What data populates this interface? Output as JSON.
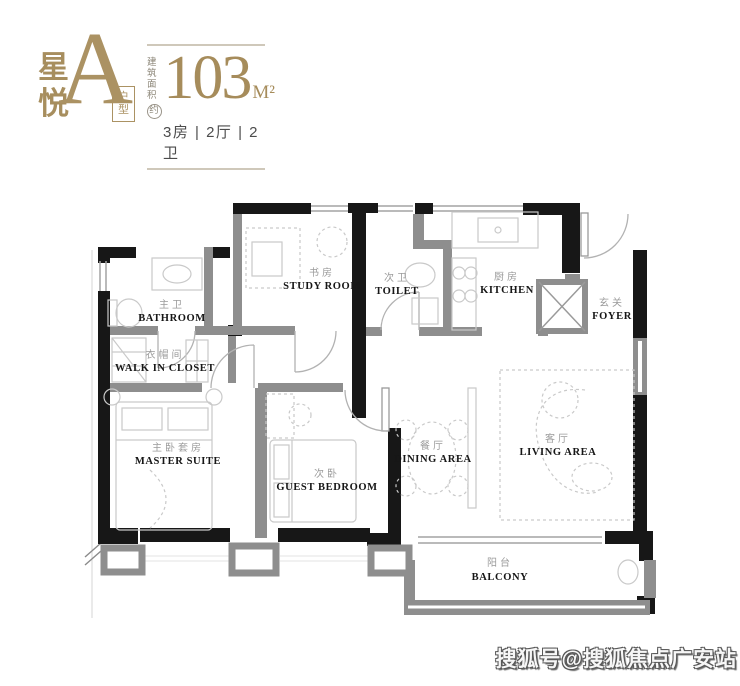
{
  "header": {
    "brand_name": "星悦",
    "unit_letter": "A",
    "unit_tag": "户型",
    "area_label_line1": "建筑",
    "area_label_line2": "面积",
    "area_approx": "约",
    "area_value": "103",
    "area_unit": "M²",
    "config": "3房 | 2厅 | 2卫",
    "accent_color": "#a68c5b"
  },
  "floorplan": {
    "rooms": [
      {
        "zh": "主卫",
        "en": "BATHROOM"
      },
      {
        "zh": "衣帽间",
        "en": "WALK IN CLOSET"
      },
      {
        "zh": "书房",
        "en": "STUDY ROOM"
      },
      {
        "zh": "次卫",
        "en": "TOILET"
      },
      {
        "zh": "厨房",
        "en": "KITCHEN"
      },
      {
        "zh": "玄关",
        "en": "FOYER"
      },
      {
        "zh": "主卧套房",
        "en": "MASTER SUITE"
      },
      {
        "zh": "次卧",
        "en": "GUEST BEDROOM"
      },
      {
        "zh": "餐厅",
        "en": "DINING AREA"
      },
      {
        "zh": "客厅",
        "en": "LIVING AREA"
      },
      {
        "zh": "阳台",
        "en": "BALCONY"
      }
    ],
    "wall_color": "#171717",
    "partition_color": "#8e8e8e",
    "label_zh_color": "#9b9b9b",
    "label_en_color": "#161616"
  },
  "watermark": {
    "text": "搜狐号@搜狐焦点广安站"
  }
}
